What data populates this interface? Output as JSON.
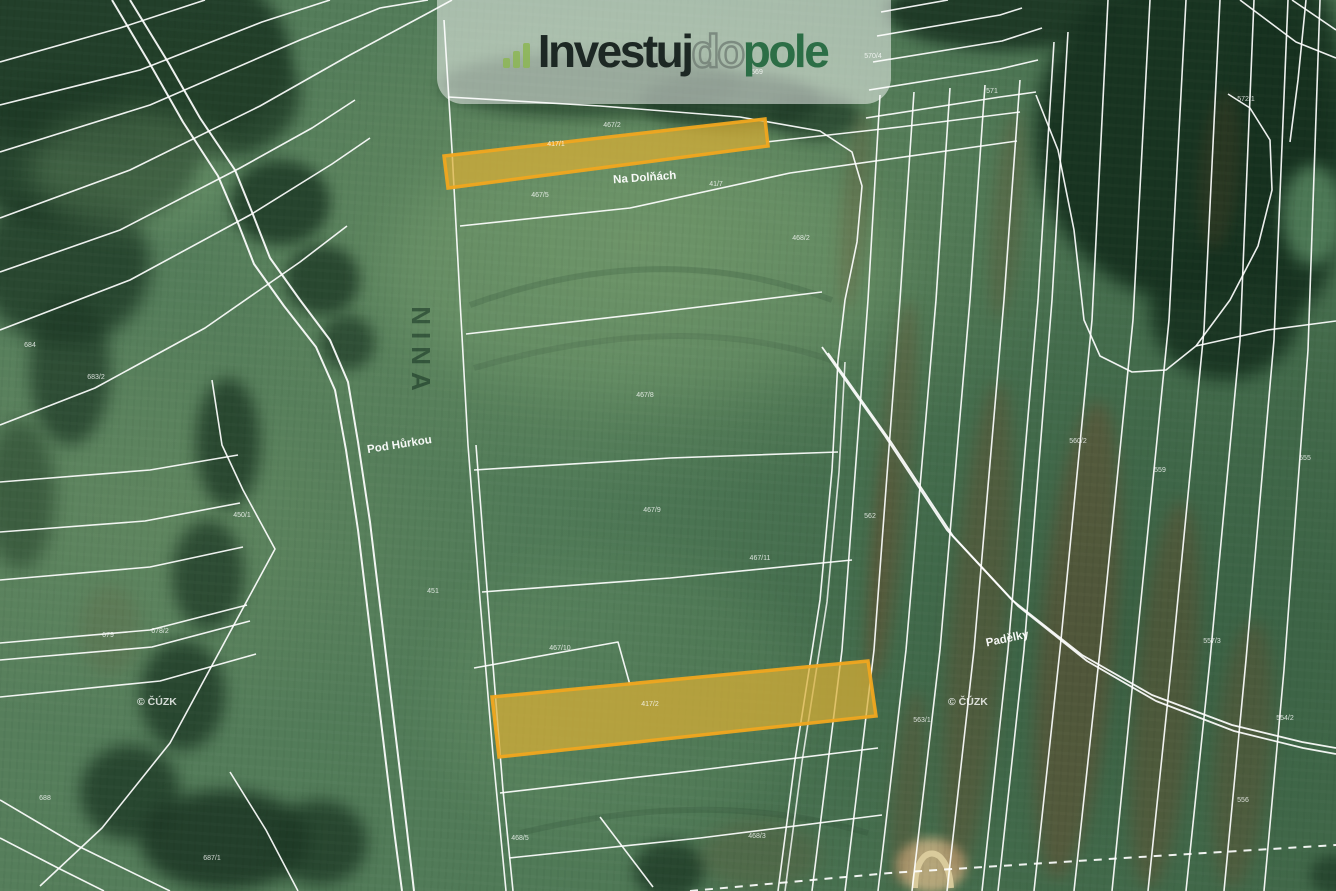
{
  "watermark": {
    "icon": "bar-chart-icon",
    "brand_prefix": "Investuj",
    "brand_mid": "do",
    "brand_suffix": "pole"
  },
  "labels": {
    "na_dolnach": "Na Dolňách",
    "pod_hurkou": "Pod Hůrkou",
    "padelky": "Padělky",
    "nina": "NINA",
    "copyright_left": "© ČÚZK",
    "copyright_right": "© ČÚZK"
  },
  "parcel_numbers": [
    {
      "x": 612,
      "y": 127,
      "text": "467/2"
    },
    {
      "x": 556,
      "y": 146,
      "text": "417/1"
    },
    {
      "x": 540,
      "y": 197,
      "text": "467/5"
    },
    {
      "x": 716,
      "y": 186,
      "text": "41/7"
    },
    {
      "x": 801,
      "y": 240,
      "text": "468/2"
    },
    {
      "x": 645,
      "y": 397,
      "text": "467/8"
    },
    {
      "x": 652,
      "y": 512,
      "text": "467/9"
    },
    {
      "x": 433,
      "y": 593,
      "text": "451"
    },
    {
      "x": 242,
      "y": 517,
      "text": "450/1"
    },
    {
      "x": 30,
      "y": 347,
      "text": "684"
    },
    {
      "x": 96,
      "y": 379,
      "text": "683/2"
    },
    {
      "x": 108,
      "y": 637,
      "text": "679"
    },
    {
      "x": 160,
      "y": 633,
      "text": "678/2"
    },
    {
      "x": 650,
      "y": 706,
      "text": "417/2"
    },
    {
      "x": 757,
      "y": 838,
      "text": "468/3"
    },
    {
      "x": 922,
      "y": 722,
      "text": "563/1"
    },
    {
      "x": 870,
      "y": 518,
      "text": "562"
    },
    {
      "x": 1078,
      "y": 443,
      "text": "560/2"
    },
    {
      "x": 1160,
      "y": 472,
      "text": "559"
    },
    {
      "x": 1212,
      "y": 643,
      "text": "557/3"
    },
    {
      "x": 1243,
      "y": 802,
      "text": "556"
    },
    {
      "x": 992,
      "y": 93,
      "text": "571"
    },
    {
      "x": 1246,
      "y": 101,
      "text": "572/1"
    },
    {
      "x": 873,
      "y": 58,
      "text": "570/4"
    },
    {
      "x": 757,
      "y": 74,
      "text": "569"
    },
    {
      "x": 1305,
      "y": 460,
      "text": "555"
    },
    {
      "x": 1285,
      "y": 720,
      "text": "554/2"
    },
    {
      "x": 45,
      "y": 800,
      "text": "688"
    },
    {
      "x": 212,
      "y": 860,
      "text": "687/1"
    },
    {
      "x": 520,
      "y": 840,
      "text": "468/5"
    },
    {
      "x": 760,
      "y": 560,
      "text": "467/11"
    },
    {
      "x": 560,
      "y": 650,
      "text": "467/10"
    }
  ],
  "colors": {
    "highlight_fill": "#d9ae35",
    "highlight_stroke": "#f0a61f",
    "boundary_line": "#ffffff",
    "brand_dark": "#1d2824",
    "brand_green": "#2c6e46",
    "brand_icon": "#8cb654",
    "logo_bg": "rgba(255,255,255,0.50)"
  }
}
